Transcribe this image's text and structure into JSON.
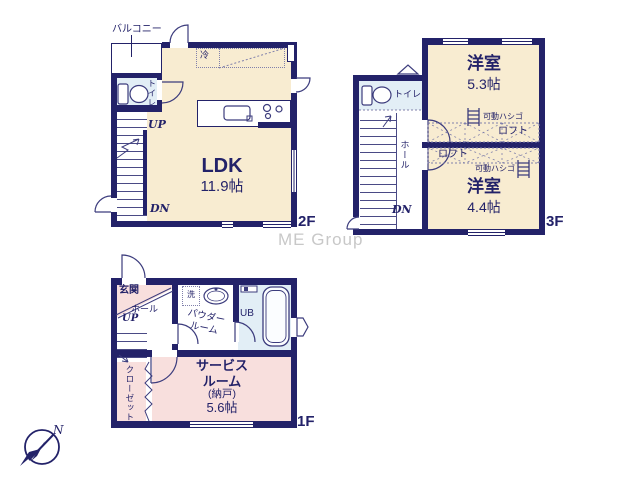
{
  "watermark": "ME Group",
  "compass": {
    "north_label": "N"
  },
  "colors": {
    "wall_navy": "#232269",
    "room_cream": "#f8ecd1",
    "room_pink": "#f8dfdd",
    "wet_area_blue": "#e2eef6",
    "text_navy": "#232269",
    "watermark_gray": "#c8c8c8"
  },
  "floor_2f": {
    "floor_label": "2F",
    "balcony_label": "バルコニー",
    "fridge_label": "冷",
    "toilet_label": "トイレ",
    "up_label": "UP",
    "down_label": "DN",
    "room": {
      "name": "LDK",
      "size": "11.9帖"
    }
  },
  "floor_3f": {
    "floor_label": "3F",
    "toilet_label": "トイレ",
    "hall_label": "ホール",
    "down_label": "DN",
    "room_upper": {
      "name": "洋室",
      "size": "5.3帖"
    },
    "room_lower": {
      "name": "洋室",
      "size": "4.4帖"
    },
    "loft_upper": {
      "ladder_label": "可動ハシゴ",
      "loft_label": "ロフト"
    },
    "loft_lower": {
      "ladder_label": "可動ハシゴ",
      "loft_label": "ロフト"
    }
  },
  "floor_1f": {
    "floor_label": "1F",
    "entrance_label": "玄関",
    "hall_label": "ホール",
    "up_label": "UP",
    "washer_label": "洗",
    "powder_room_line1": "パウダー",
    "powder_room_line2": "ルーム",
    "bath_label": "UB",
    "closet_label": "クローゼット",
    "service_room": {
      "line1": "サービス",
      "line2": "ルーム",
      "line3": "(納戸)",
      "line4": "5.6帖"
    }
  }
}
